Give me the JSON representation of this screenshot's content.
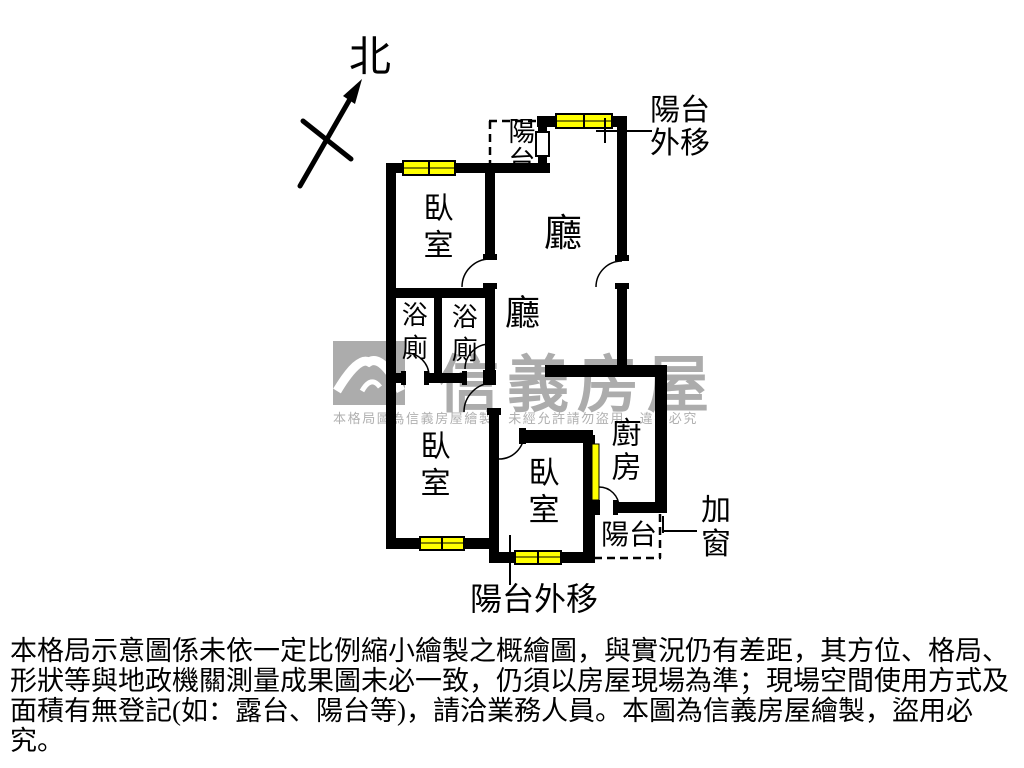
{
  "floor_plan": {
    "north_label": "北",
    "rooms": {
      "bedroom_top": "臥室",
      "bedroom_bottom_left": "臥室",
      "bedroom_bottom_middle": "臥室",
      "living_upper": "廳",
      "living_lower": "廳",
      "bathroom_left": "浴廁",
      "bathroom_right": "浴廁",
      "kitchen": "廚房",
      "balcony_upper": "陽台",
      "balcony_lower": "陽台"
    },
    "annotations": {
      "balcony_moved_out_top": "陽台外移",
      "balcony_moved_out_bottom": "陽台外移",
      "added_window": "加窗"
    }
  },
  "watermark": {
    "brand": "信義房屋",
    "notice": "本格局圖為信義房屋繪製，未經允許請勿盜用，違者必究"
  },
  "disclaimer": [
    "本格局示意圖係未依一定比例縮小繪製之概繪圖，與實況仍有差距，其方位、格局、",
    "形狀等與地政機關測量成果圖未必一致，仍須以房屋現場為準；現場空間使用方式及",
    "面積有無登記(如：露台、陽台等)，請洽業務人員。本圖為信義房屋繪製，盜用必究。"
  ],
  "colors": {
    "wall": "#000000",
    "window_fill": "#ffff00",
    "watermark_gray": "#acacac"
  }
}
